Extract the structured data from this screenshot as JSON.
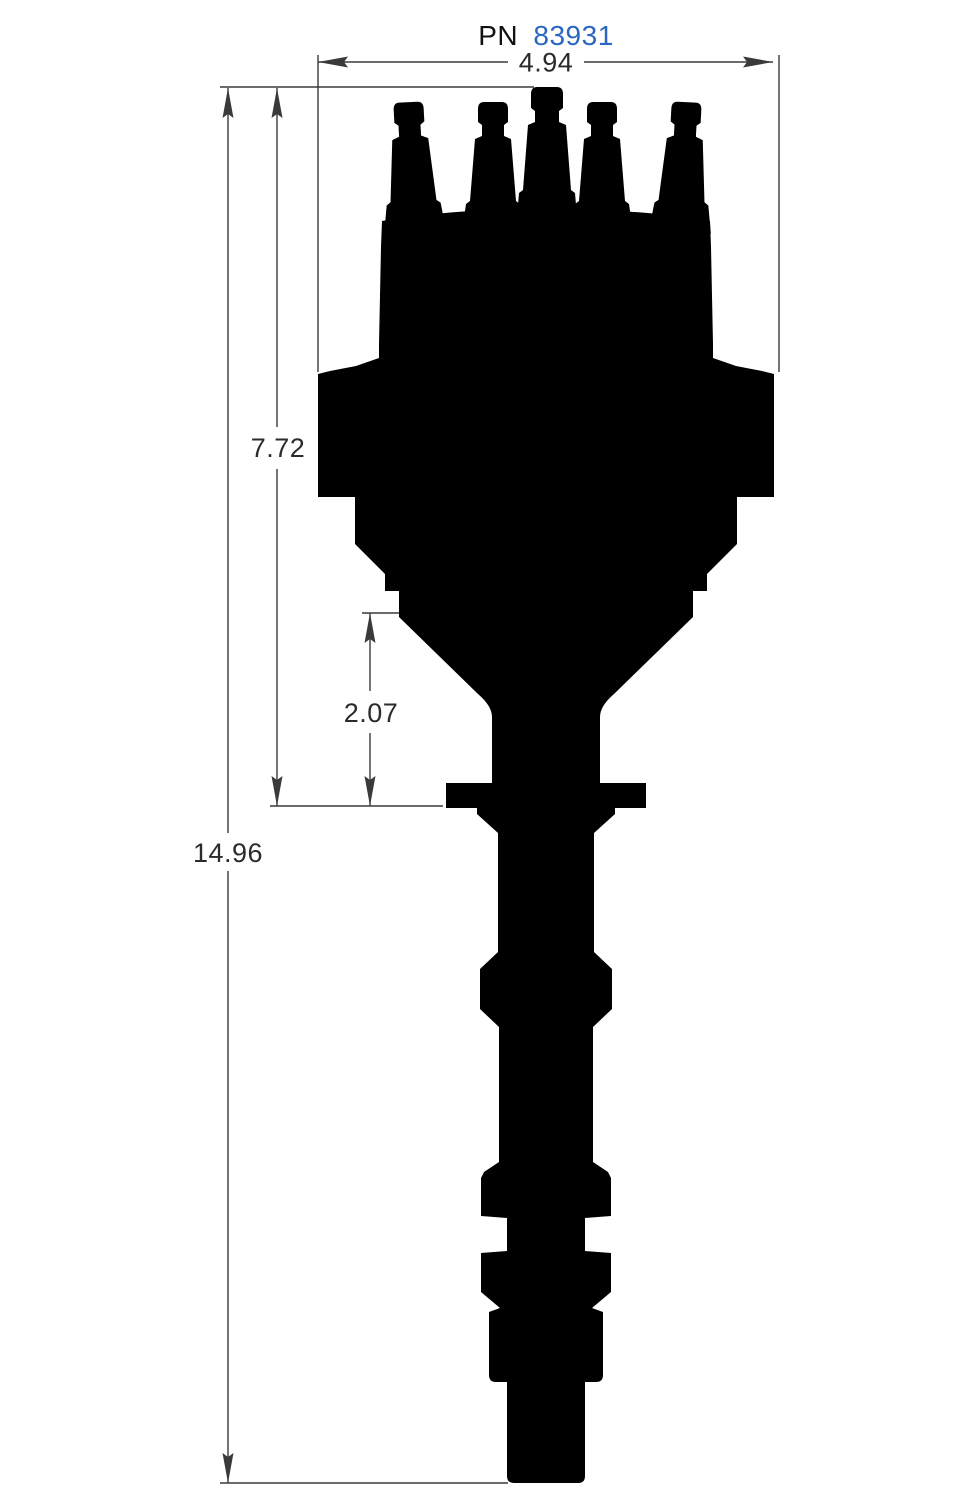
{
  "title": {
    "prefix": "PN",
    "number": "83931",
    "number_color": "#2b66c4",
    "prefix_color": "#111111"
  },
  "dimensions": {
    "cap_width": {
      "value": "4.94"
    },
    "cap_height": {
      "value": "7.72"
    },
    "lower_section": {
      "value": "2.07"
    },
    "overall_height": {
      "value": "14.96"
    }
  },
  "colors": {
    "silhouette": "#000000",
    "dimension_lines": "#3a3a3a",
    "text": "#2b2b2b",
    "background": "#ffffff"
  }
}
